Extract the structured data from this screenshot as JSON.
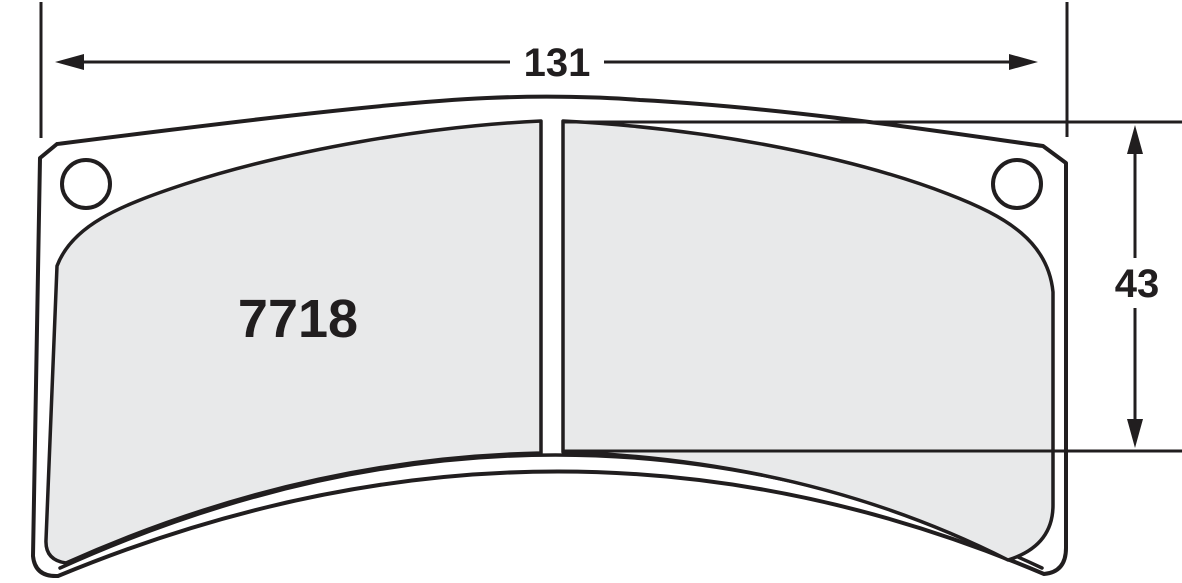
{
  "diagram": {
    "title": "Brake pad dimension drawing",
    "part_number": "7718",
    "dimensions": {
      "width_label": "131",
      "height_label": "43"
    },
    "colors": {
      "line": "#211e1f",
      "friction_fill": "#e8e9ea",
      "plate_fill": "#ffffff",
      "background": "#ffffff"
    }
  }
}
